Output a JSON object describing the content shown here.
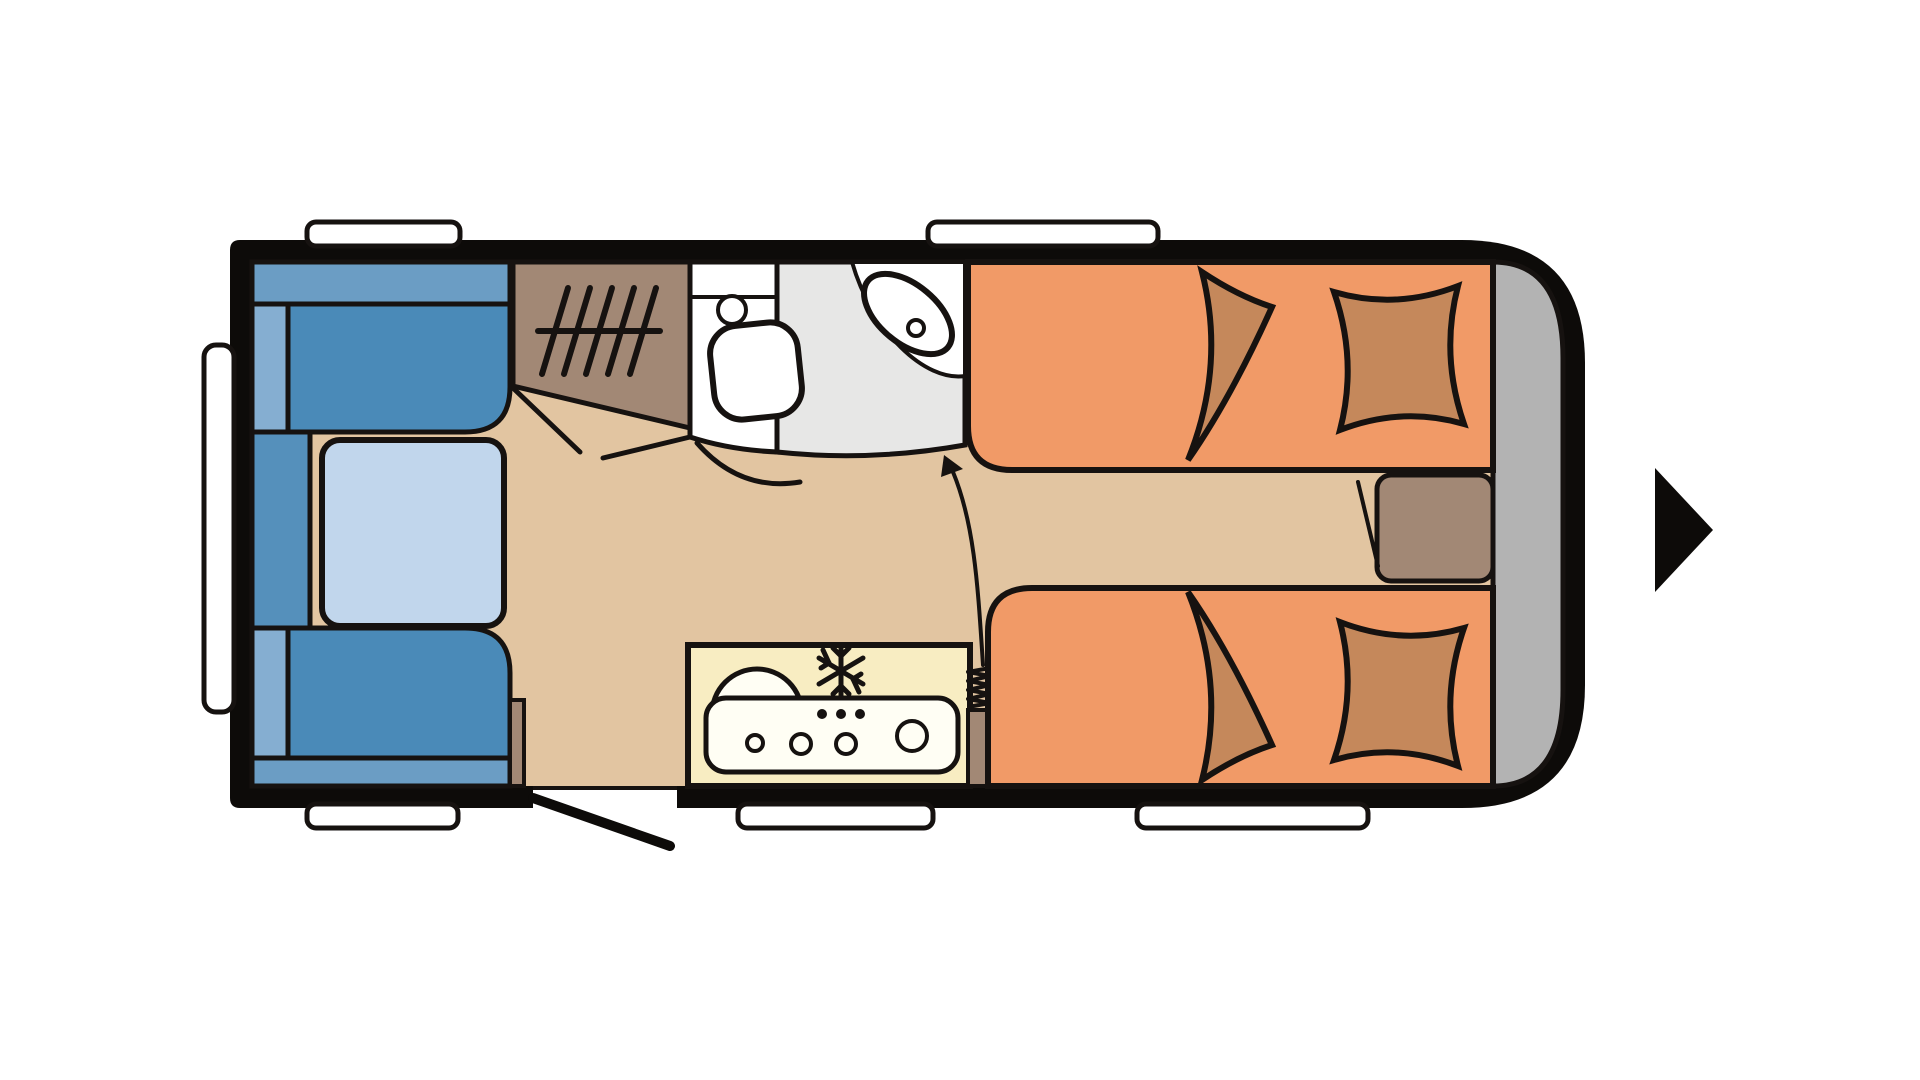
{
  "diagram": {
    "type": "caravan-floor-plan",
    "description": "Top-view floor plan of a travel caravan, entrance door open at bottom centre, direction-of-travel arrow pointing right",
    "rooms": {
      "lounge": "front dinette with two facing bench seats and table",
      "wardrobe": "wardrobe with hanging rail symbol",
      "washroom": "washroom with toilet, corner wash basin and shower floor",
      "kitchen": "kitchen block with round sink, hob burners and fridge symbol",
      "bedroom": "two single beds with pillows and cushions, bedside chest between",
      "rear_storage": "rear storage compartment"
    },
    "symbols": {
      "snowflake": "fridge / freezer position",
      "coil": "heater position",
      "hanger_rail": "wardrobe hanging rail",
      "curved_arrow": "walkway from kitchen area to washroom",
      "direction_arrow": "direction of travel (points right)",
      "door_swing": "open entrance door at bottom wall"
    },
    "windows": {
      "count": 6,
      "positions": [
        "front (left end)",
        "top left",
        "top right",
        "bottom left",
        "bottom centre",
        "bottom right"
      ]
    }
  },
  "colors": {
    "line": "#161210",
    "wall": "#0d0b09",
    "floor": "#e2c5a1",
    "bed_orange": "#f19a67",
    "pillow": "#c5885b",
    "wood_brown": "#a28875",
    "seat_dark": "#4a8ab8",
    "seat_medium": "#6b9dc4",
    "seat_light": "#85aed1",
    "seat_side": "#5590bb",
    "table_blue": "#c1d6ec",
    "kitchen_yellow": "#f8edc2",
    "counter_cream": "#fffef4",
    "shower_gray": "#e7e7e6",
    "storage_gray": "#b3b3b3",
    "white": "#ffffff"
  }
}
